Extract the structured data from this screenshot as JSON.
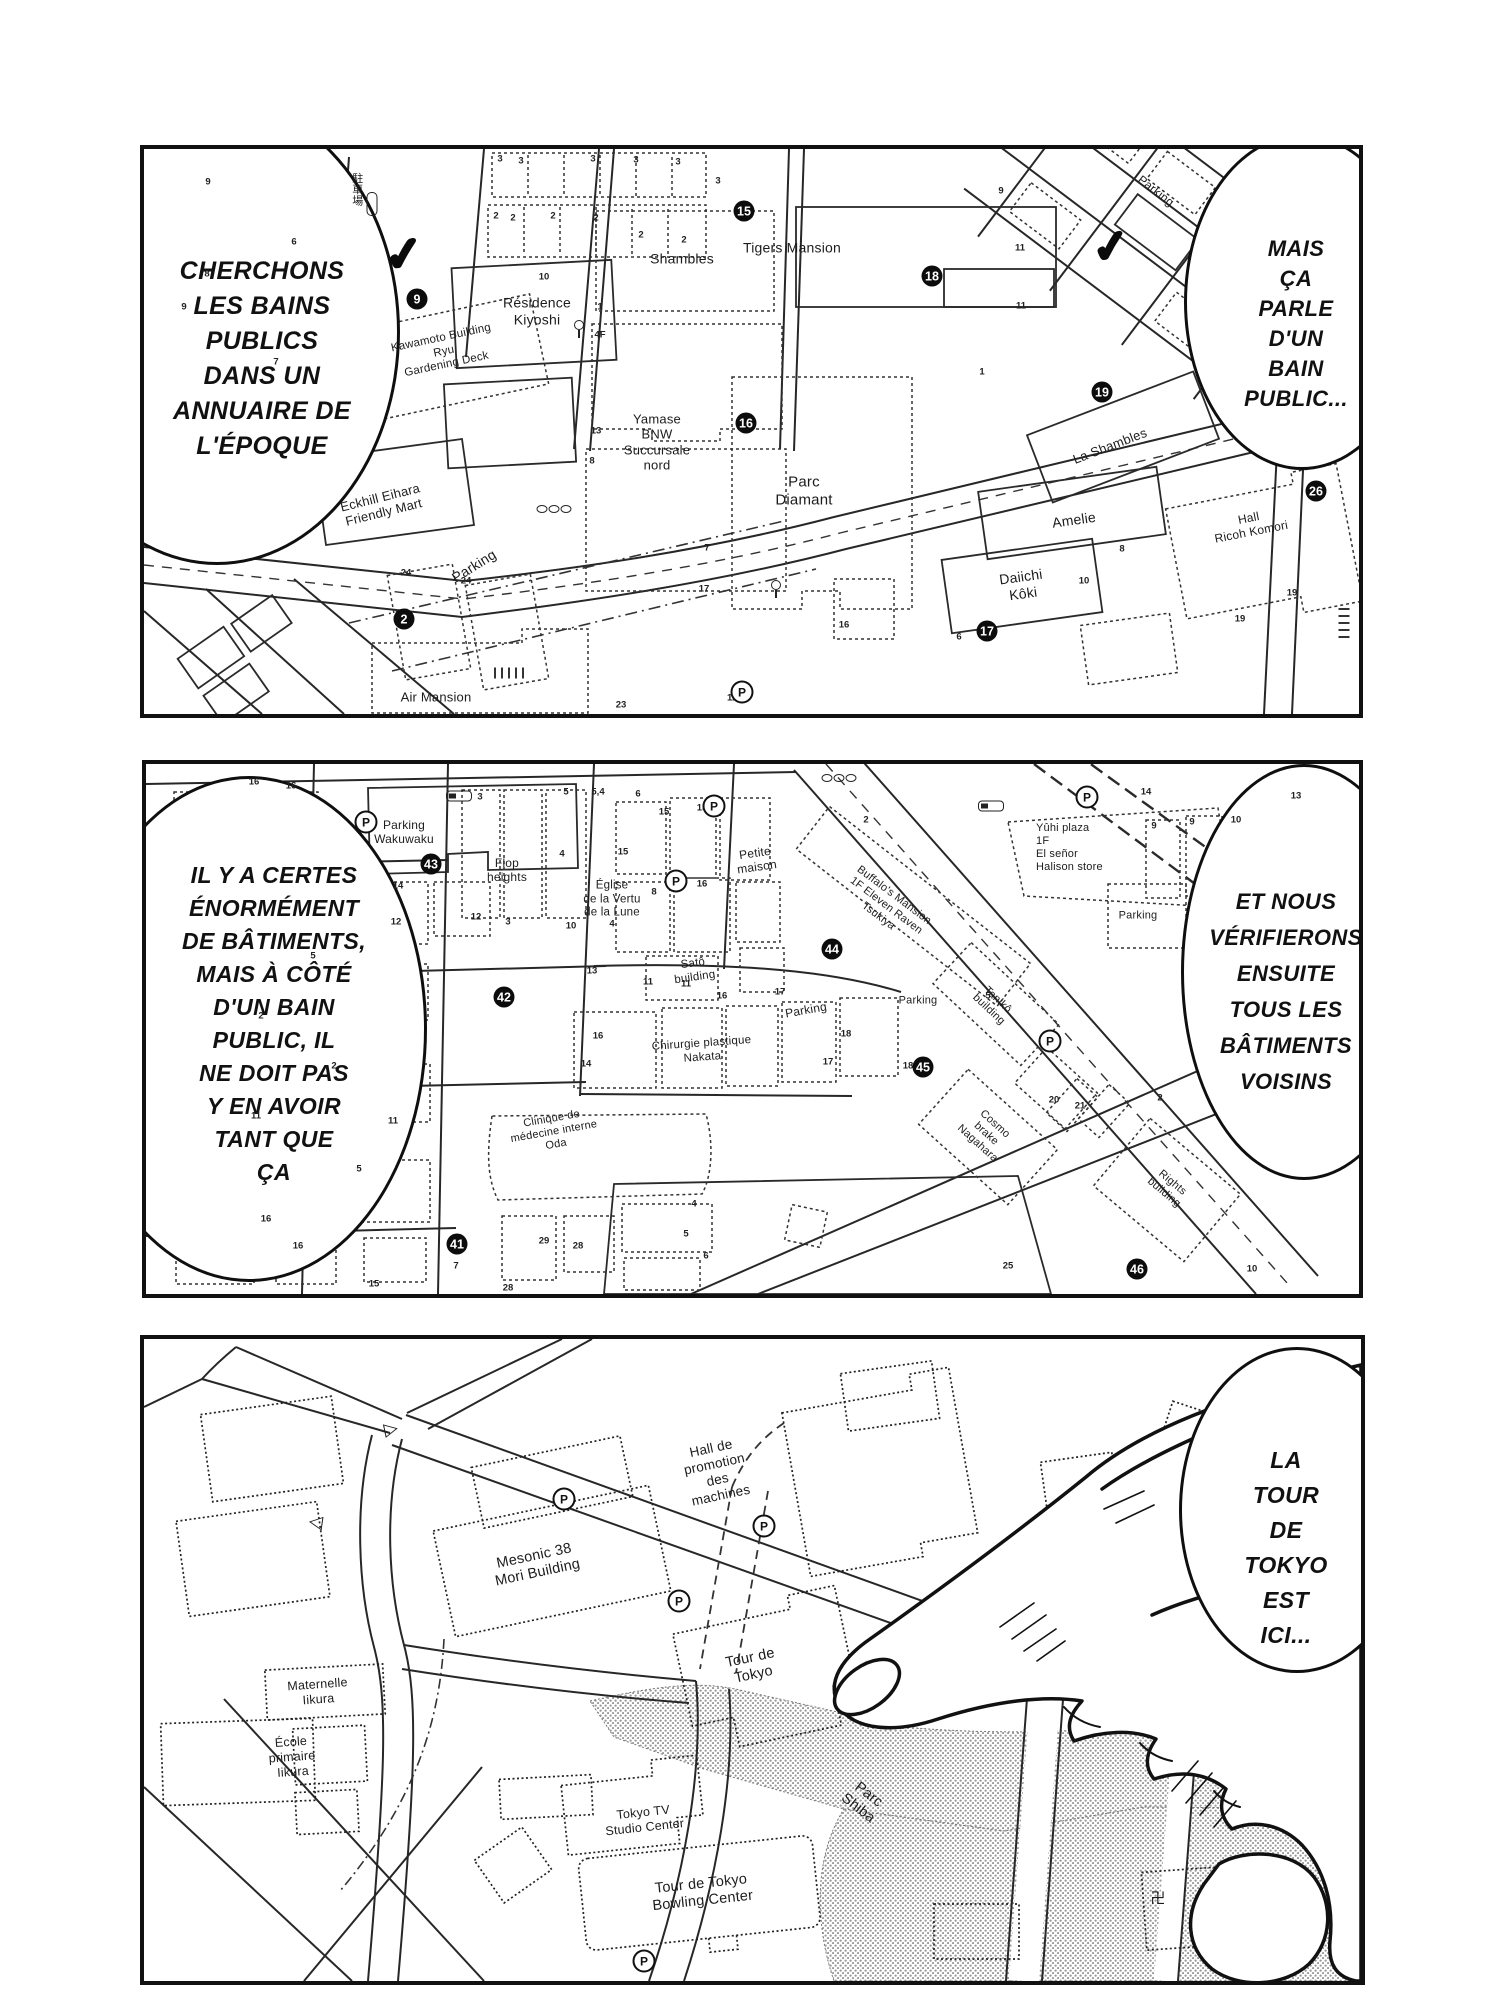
{
  "colors": {
    "ink": "#111111",
    "paper": "#ffffff",
    "shade_dot": "#9a9a9a"
  },
  "panels": [
    {
      "id": "p1",
      "bubbles": [
        {
          "name": "speech-bubble-search",
          "cx": 70,
          "cy": 180,
          "rx": 180,
          "ry": 230,
          "tx": 118,
          "ty": 105,
          "fs": 25,
          "lh": 35,
          "lines": [
            "CHERCHONS",
            "LES BAINS",
            "PUBLICS",
            "DANS UN",
            "ANNUAIRE DE",
            "L'ÉPOQUE"
          ]
        },
        {
          "name": "speech-bubble-bain-public",
          "cx": 1155,
          "cy": 150,
          "rx": 115,
          "ry": 165,
          "tx": 1152,
          "ty": 85,
          "fs": 22,
          "lh": 30,
          "lines": [
            "MAIS",
            "ÇA PARLE",
            "D'UN BAIN",
            "PUBLIC..."
          ]
        }
      ],
      "labels": [
        {
          "t": "駐車場",
          "x": 212,
          "y": 40,
          "fs": 11,
          "v": 1
        },
        {
          "t": "Résidence\nKiyoshi",
          "x": 393,
          "y": 162,
          "fs": 14
        },
        {
          "t": "Kawamoto Building\nRyu\nGardening Deck",
          "x": 300,
          "y": 203,
          "fs": 11.5,
          "r": -12
        },
        {
          "t": "Shambles",
          "x": 538,
          "y": 110,
          "fs": 14
        },
        {
          "t": "Tigers Mansion",
          "x": 648,
          "y": 99,
          "fs": 14
        },
        {
          "t": "Yamase\nBNW\nSuccursale\nnord",
          "x": 513,
          "y": 293,
          "fs": 13
        },
        {
          "t": "Parc\nDiamant",
          "x": 660,
          "y": 342,
          "fs": 15
        },
        {
          "t": "Eckhill Eihara\nFriendly Mart",
          "x": 238,
          "y": 356,
          "fs": 13,
          "r": -14
        },
        {
          "t": "Parking",
          "x": 330,
          "y": 417,
          "fs": 14,
          "r": -32
        },
        {
          "t": "Air Mansion",
          "x": 292,
          "y": 548,
          "fs": 13
        },
        {
          "t": "Parking",
          "x": 1012,
          "y": 42,
          "fs": 12,
          "r": 38
        },
        {
          "t": "La Shambles",
          "x": 966,
          "y": 297,
          "fs": 13,
          "r": -21
        },
        {
          "t": "Amelie",
          "x": 930,
          "y": 371,
          "fs": 14,
          "r": -8
        },
        {
          "t": "Daiichi\nKôki",
          "x": 878,
          "y": 436,
          "fs": 14,
          "r": -8
        },
        {
          "t": "Hall\nRicoh Komori",
          "x": 1106,
          "y": 376,
          "fs": 12,
          "r": -11
        }
      ],
      "markers": [
        {
          "n": "9",
          "x": 273,
          "y": 150
        },
        {
          "n": "15",
          "x": 600,
          "y": 62
        },
        {
          "n": "16",
          "x": 602,
          "y": 274
        },
        {
          "n": "18",
          "x": 788,
          "y": 127
        },
        {
          "n": "19",
          "x": 958,
          "y": 243
        },
        {
          "n": "2",
          "x": 260,
          "y": 470
        },
        {
          "n": "17",
          "x": 843,
          "y": 482
        },
        {
          "n": "26",
          "x": 1172,
          "y": 342
        }
      ],
      "picons": [
        {
          "x": 598,
          "y": 543
        }
      ],
      "checks": [
        {
          "x": 260,
          "y": 105,
          "s": 46
        },
        {
          "x": 967,
          "y": 98,
          "s": 44
        }
      ],
      "icons": [
        {
          "k": "pillv",
          "x": 228,
          "y": 55
        },
        {
          "k": "post",
          "x": 435,
          "y": 180
        },
        {
          "k": "post",
          "x": 632,
          "y": 440
        },
        {
          "k": "ovals",
          "x": 410,
          "y": 360
        },
        {
          "k": "ladh",
          "x": 365,
          "y": 524
        },
        {
          "k": "ladv",
          "x": 1200,
          "y": 472
        }
      ],
      "nums": [
        {
          "t": "3",
          "x": 356,
          "y": 10
        },
        {
          "t": "3",
          "x": 377,
          "y": 12
        },
        {
          "t": "3",
          "x": 449,
          "y": 10
        },
        {
          "t": "3",
          "x": 492,
          "y": 11
        },
        {
          "t": "3",
          "x": 534,
          "y": 13
        },
        {
          "t": "3",
          "x": 574,
          "y": 32
        },
        {
          "t": "2",
          "x": 352,
          "y": 67
        },
        {
          "t": "2",
          "x": 369,
          "y": 69
        },
        {
          "t": "2",
          "x": 409,
          "y": 67
        },
        {
          "t": "2",
          "x": 452,
          "y": 69
        },
        {
          "t": "2",
          "x": 497,
          "y": 86
        },
        {
          "t": "2",
          "x": 540,
          "y": 91
        },
        {
          "t": "9",
          "x": 64,
          "y": 33
        },
        {
          "t": "6",
          "x": 150,
          "y": 93
        },
        {
          "t": "8",
          "x": 63,
          "y": 125
        },
        {
          "t": "9",
          "x": 40,
          "y": 158
        },
        {
          "t": "7",
          "x": 132,
          "y": 213
        },
        {
          "t": "10",
          "x": 400,
          "y": 128
        },
        {
          "t": "1",
          "x": 456,
          "y": 158
        },
        {
          "t": "4F",
          "x": 456,
          "y": 186
        },
        {
          "t": "13",
          "x": 452,
          "y": 282
        },
        {
          "t": "8",
          "x": 448,
          "y": 312
        },
        {
          "t": "9",
          "x": 857,
          "y": 42
        },
        {
          "t": "11",
          "x": 876,
          "y": 99
        },
        {
          "t": "11",
          "x": 877,
          "y": 157
        },
        {
          "t": "1",
          "x": 838,
          "y": 223
        },
        {
          "t": "7",
          "x": 563,
          "y": 399
        },
        {
          "t": "24",
          "x": 262,
          "y": 424
        },
        {
          "t": "24",
          "x": 322,
          "y": 432
        },
        {
          "t": "23",
          "x": 477,
          "y": 556
        },
        {
          "t": "11",
          "x": 588,
          "y": 549
        },
        {
          "t": "16",
          "x": 700,
          "y": 476
        },
        {
          "t": "19",
          "x": 1096,
          "y": 470
        },
        {
          "t": "19",
          "x": 1148,
          "y": 444
        },
        {
          "t": "10",
          "x": 940,
          "y": 432
        },
        {
          "t": "8",
          "x": 978,
          "y": 400
        },
        {
          "t": "6",
          "x": 815,
          "y": 488
        },
        {
          "t": "17",
          "x": 560,
          "y": 440
        }
      ]
    },
    {
      "id": "p2",
      "bubbles": [
        {
          "name": "speech-bubble-batiments",
          "cx": 100,
          "cy": 262,
          "rx": 175,
          "ry": 250,
          "tx": 128,
          "ty": 95,
          "fs": 23,
          "lh": 33,
          "lines": [
            "IL Y A CERTES",
            "ÉNORMÉMENT",
            "DE BÂTIMENTS,",
            "MAIS À CÔTÉ",
            "D'UN BAIN",
            "PUBLIC, IL",
            "NE DOIT PAS",
            "Y EN AVOIR",
            "TANT QUE",
            "ÇA"
          ]
        },
        {
          "name": "speech-bubble-verifierons",
          "cx": 1155,
          "cy": 205,
          "rx": 120,
          "ry": 205,
          "tx": 1140,
          "ty": 120,
          "fs": 22,
          "lh": 36,
          "lines": [
            "ET NOUS",
            "VÉRIFIERONS",
            "ENSUITE",
            "TOUS LES",
            "BÂTIMENTS",
            "VOISINS"
          ]
        }
      ],
      "labels": [
        {
          "t": "Parking\nWakuwaku",
          "x": 258,
          "y": 68,
          "fs": 12
        },
        {
          "t": "Flop\nheights",
          "x": 361,
          "y": 106,
          "fs": 12
        },
        {
          "t": "Église\nde la Vertu\nde la Lune",
          "x": 466,
          "y": 136,
          "fs": 11.5
        },
        {
          "t": "Petite\nmaison",
          "x": 610,
          "y": 96,
          "fs": 12,
          "r": -8
        },
        {
          "t": "Buffalo's Mansion\n1F Eleven Raven\nTsukiya",
          "x": 740,
          "y": 142,
          "fs": 11,
          "r": 37
        },
        {
          "t": "Satô\nbuilding",
          "x": 548,
          "y": 207,
          "fs": 11.5,
          "r": -8
        },
        {
          "t": "Parking",
          "x": 660,
          "y": 246,
          "fs": 12,
          "r": -10
        },
        {
          "t": "Parking",
          "x": 772,
          "y": 237,
          "fs": 11
        },
        {
          "t": "Chirurgie plastique\nNakata",
          "x": 556,
          "y": 287,
          "fs": 11.5,
          "r": -4
        },
        {
          "t": "Yûhi plaza\n1F\nEl señor\nHalison store",
          "x": 890,
          "y": 84,
          "fs": 11,
          "left": 1
        },
        {
          "t": "Parking",
          "x": 992,
          "y": 152,
          "fs": 11
        },
        {
          "t": "Tanikô\nbuilding",
          "x": 847,
          "y": 241,
          "fs": 11,
          "r": 43
        },
        {
          "t": "Cosmo\nbrake\nNagahara",
          "x": 840,
          "y": 370,
          "fs": 11,
          "r": 42
        },
        {
          "t": "Rights\nbuilding",
          "x": 1022,
          "y": 424,
          "fs": 11,
          "r": 40
        },
        {
          "t": "Clinique de\nmédecine interne\nOda",
          "x": 408,
          "y": 368,
          "fs": 11,
          "r": -10
        }
      ],
      "markers": [
        {
          "n": "43",
          "x": 285,
          "y": 100
        },
        {
          "n": "42",
          "x": 358,
          "y": 233
        },
        {
          "n": "44",
          "x": 686,
          "y": 185
        },
        {
          "n": "45",
          "x": 777,
          "y": 303
        },
        {
          "n": "41",
          "x": 311,
          "y": 480
        },
        {
          "n": "46",
          "x": 991,
          "y": 505
        }
      ],
      "picons": [
        {
          "x": 220,
          "y": 58
        },
        {
          "x": 568,
          "y": 42
        },
        {
          "x": 530,
          "y": 117
        },
        {
          "x": 904,
          "y": 277
        },
        {
          "x": 941,
          "y": 33
        }
      ],
      "checks": [],
      "icons": [
        {
          "k": "gate",
          "x": 313,
          "y": 32
        },
        {
          "k": "gate",
          "x": 845,
          "y": 42
        },
        {
          "k": "ovals",
          "x": 693,
          "y": 14
        }
      ],
      "nums": [
        {
          "t": "3",
          "x": 334,
          "y": 33
        },
        {
          "t": "4",
          "x": 416,
          "y": 90
        },
        {
          "t": "12",
          "x": 330,
          "y": 153
        },
        {
          "t": "3",
          "x": 362,
          "y": 158
        },
        {
          "t": "10",
          "x": 425,
          "y": 162
        },
        {
          "t": "4",
          "x": 466,
          "y": 160
        },
        {
          "t": "14",
          "x": 252,
          "y": 122
        },
        {
          "t": "12",
          "x": 250,
          "y": 158
        },
        {
          "t": "5",
          "x": 420,
          "y": 28
        },
        {
          "t": "5,4",
          "x": 452,
          "y": 28
        },
        {
          "t": "6",
          "x": 492,
          "y": 30
        },
        {
          "t": "8",
          "x": 508,
          "y": 128
        },
        {
          "t": "15",
          "x": 518,
          "y": 48
        },
        {
          "t": "15",
          "x": 556,
          "y": 44
        },
        {
          "t": "15",
          "x": 477,
          "y": 88
        },
        {
          "t": "16",
          "x": 556,
          "y": 120
        },
        {
          "t": "13",
          "x": 446,
          "y": 207
        },
        {
          "t": "11",
          "x": 502,
          "y": 218
        },
        {
          "t": "11",
          "x": 540,
          "y": 220
        },
        {
          "t": "16",
          "x": 576,
          "y": 232
        },
        {
          "t": "17",
          "x": 634,
          "y": 228
        },
        {
          "t": "16",
          "x": 452,
          "y": 272
        },
        {
          "t": "14",
          "x": 440,
          "y": 300
        },
        {
          "t": "18",
          "x": 700,
          "y": 270
        },
        {
          "t": "17",
          "x": 682,
          "y": 298
        },
        {
          "t": "18",
          "x": 762,
          "y": 302
        },
        {
          "t": "5",
          "x": 167,
          "y": 192
        },
        {
          "t": "2",
          "x": 115,
          "y": 252
        },
        {
          "t": "2",
          "x": 188,
          "y": 302
        },
        {
          "t": "11",
          "x": 110,
          "y": 352
        },
        {
          "t": "11",
          "x": 247,
          "y": 357
        },
        {
          "t": "5",
          "x": 213,
          "y": 405
        },
        {
          "t": "16",
          "x": 120,
          "y": 455
        },
        {
          "t": "16",
          "x": 152,
          "y": 482
        },
        {
          "t": "15",
          "x": 228,
          "y": 520
        },
        {
          "t": "7",
          "x": 310,
          "y": 502
        },
        {
          "t": "29",
          "x": 398,
          "y": 477
        },
        {
          "t": "28",
          "x": 432,
          "y": 482
        },
        {
          "t": "28",
          "x": 362,
          "y": 524
        },
        {
          "t": "2",
          "x": 720,
          "y": 56
        },
        {
          "t": "9",
          "x": 1008,
          "y": 62
        },
        {
          "t": "9",
          "x": 1046,
          "y": 58
        },
        {
          "t": "10",
          "x": 1090,
          "y": 56
        },
        {
          "t": "13",
          "x": 1150,
          "y": 32
        },
        {
          "t": "14",
          "x": 1000,
          "y": 28
        },
        {
          "t": "16",
          "x": 108,
          "y": 18
        },
        {
          "t": "16",
          "x": 145,
          "y": 22
        },
        {
          "t": "20",
          "x": 908,
          "y": 336
        },
        {
          "t": "21",
          "x": 934,
          "y": 342
        },
        {
          "t": "25",
          "x": 862,
          "y": 502
        },
        {
          "t": "2",
          "x": 1014,
          "y": 334
        },
        {
          "t": "10",
          "x": 1106,
          "y": 505
        },
        {
          "t": "5",
          "x": 842,
          "y": 232
        },
        {
          "t": "5",
          "x": 540,
          "y": 470
        },
        {
          "t": "6",
          "x": 560,
          "y": 492
        },
        {
          "t": "4",
          "x": 548,
          "y": 440
        }
      ]
    },
    {
      "id": "p3",
      "bubbles": [
        {
          "name": "speech-bubble-tour-tokyo",
          "cx": 1150,
          "cy": 168,
          "rx": 115,
          "ry": 160,
          "tx": 1142,
          "ty": 104,
          "fs": 23,
          "lh": 35,
          "lines": [
            "LA TOUR",
            "DE TOKYO",
            "EST ICI..."
          ]
        }
      ],
      "labels": [
        {
          "t": "Hall de\npromotion\ndes\nmachines",
          "x": 572,
          "y": 133,
          "fs": 13.5,
          "r": -12
        },
        {
          "t": "Mesonic 38\nMori Building",
          "x": 392,
          "y": 226,
          "fs": 14.5,
          "r": -12
        },
        {
          "t": "Tour de\nTokyo",
          "x": 608,
          "y": 328,
          "fs": 14.5,
          "r": -12
        },
        {
          "t": "Maternelle\nIikura",
          "x": 174,
          "y": 353,
          "fs": 12.5,
          "r": -4
        },
        {
          "t": "École\nprimaire\nIikura",
          "x": 148,
          "y": 418,
          "fs": 12.5,
          "r": -4
        },
        {
          "t": "Tokyo TV\nStudio Center",
          "x": 500,
          "y": 481,
          "fs": 12.5,
          "r": -6
        },
        {
          "t": "Tour de Tokyo\nBowling Center",
          "x": 558,
          "y": 554,
          "fs": 14.5,
          "r": -6
        },
        {
          "t": "Parc\nShiba",
          "x": 719,
          "y": 463,
          "fs": 14.5,
          "r": 38
        },
        {
          "t": "▷",
          "x": 247,
          "y": 90,
          "fs": 18,
          "r": -12
        },
        {
          "t": "◁",
          "x": 172,
          "y": 183,
          "fs": 18,
          "r": 8
        }
      ],
      "markers": [],
      "picons": [
        {
          "x": 420,
          "y": 160
        },
        {
          "x": 620,
          "y": 187
        },
        {
          "x": 535,
          "y": 262
        },
        {
          "x": 500,
          "y": 622
        }
      ],
      "checks": [],
      "icons": [
        {
          "k": "manji",
          "x": 1014,
          "y": 560,
          "t": "卍"
        }
      ],
      "nums": []
    }
  ]
}
